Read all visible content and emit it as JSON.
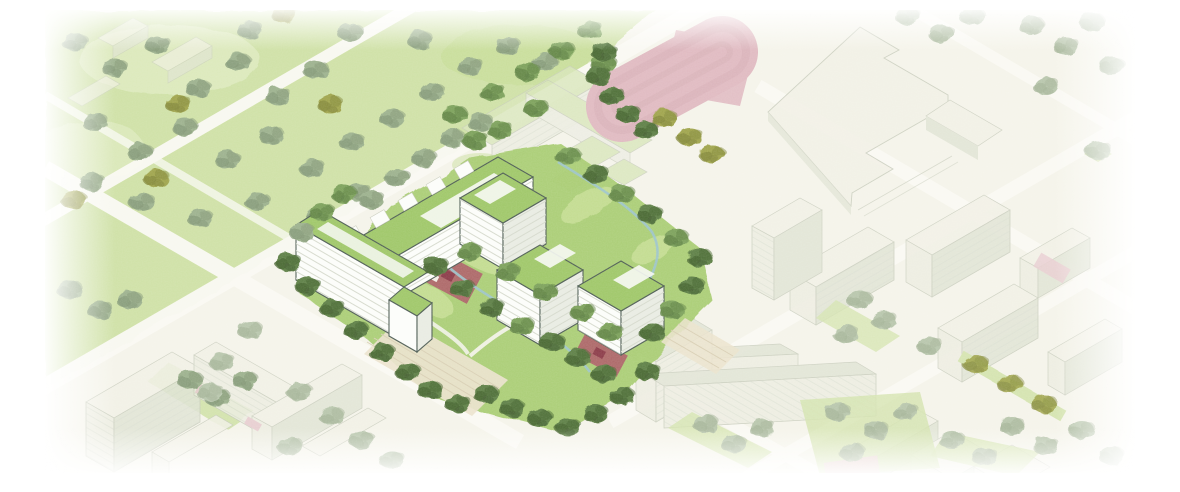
{
  "canvas": {
    "width": 1180,
    "height": 492
  },
  "colors": {
    "page": "#ffffff",
    "ground": "#f5f4ea",
    "street": "#fbfaf4",
    "park": "#cfe1a6",
    "park_light": "#deebc0",
    "lawn": "#c3dc90",
    "site_green": "#a7cb70",
    "roof_green": "#9fc768",
    "roof_pale": "#d8e6ba",
    "ctx_roof": "#f1f0e6",
    "ctx_wall": "#ecede1",
    "ctx_shade": "#dfe3d4",
    "ctx_line": "#c7cbbb",
    "wall": "#fcfdfa",
    "wall_shade": "#e9ece3",
    "outline": "#4e5d54",
    "floor": "#d6dacd",
    "sage1": "#9cb18d",
    "sage2": "#839876",
    "dark1": "#5d7f44",
    "dark2": "#44612e",
    "mid1": "#7ba15a",
    "mid2": "#5d8042",
    "faded1": "#b8c6ac",
    "faded2": "#a5b498",
    "olive1": "#9fa44b",
    "olive2": "#828739",
    "pink": "#e0bac1",
    "pink_line": "#d2a8b1",
    "pink_soft": "#e6c8cd",
    "red": "#ae5a66",
    "red_dark": "#8c3b48",
    "stream": "#9cc4cc",
    "plaza": "#ebe3cd",
    "plaza_line": "#d9cfb4"
  },
  "scene": {
    "type": "axonometric-masterplan-rendering",
    "focus_site": {
      "buildings": [
        "north-slab",
        "west-slab",
        "pavilion-1",
        "pavilion-2",
        "pavilion-3"
      ],
      "landscape": [
        "courtyard-garden",
        "play-area-north",
        "play-area-south",
        "stream",
        "street-tree-rows",
        "south-plaza-terraces"
      ]
    },
    "context": [
      "public-park",
      "school-complex",
      "sports-track",
      "sports-court",
      "large-institutional-building",
      "residential-blocks",
      "street-grid",
      "street-trees",
      "courtyard-playgrounds"
    ]
  }
}
